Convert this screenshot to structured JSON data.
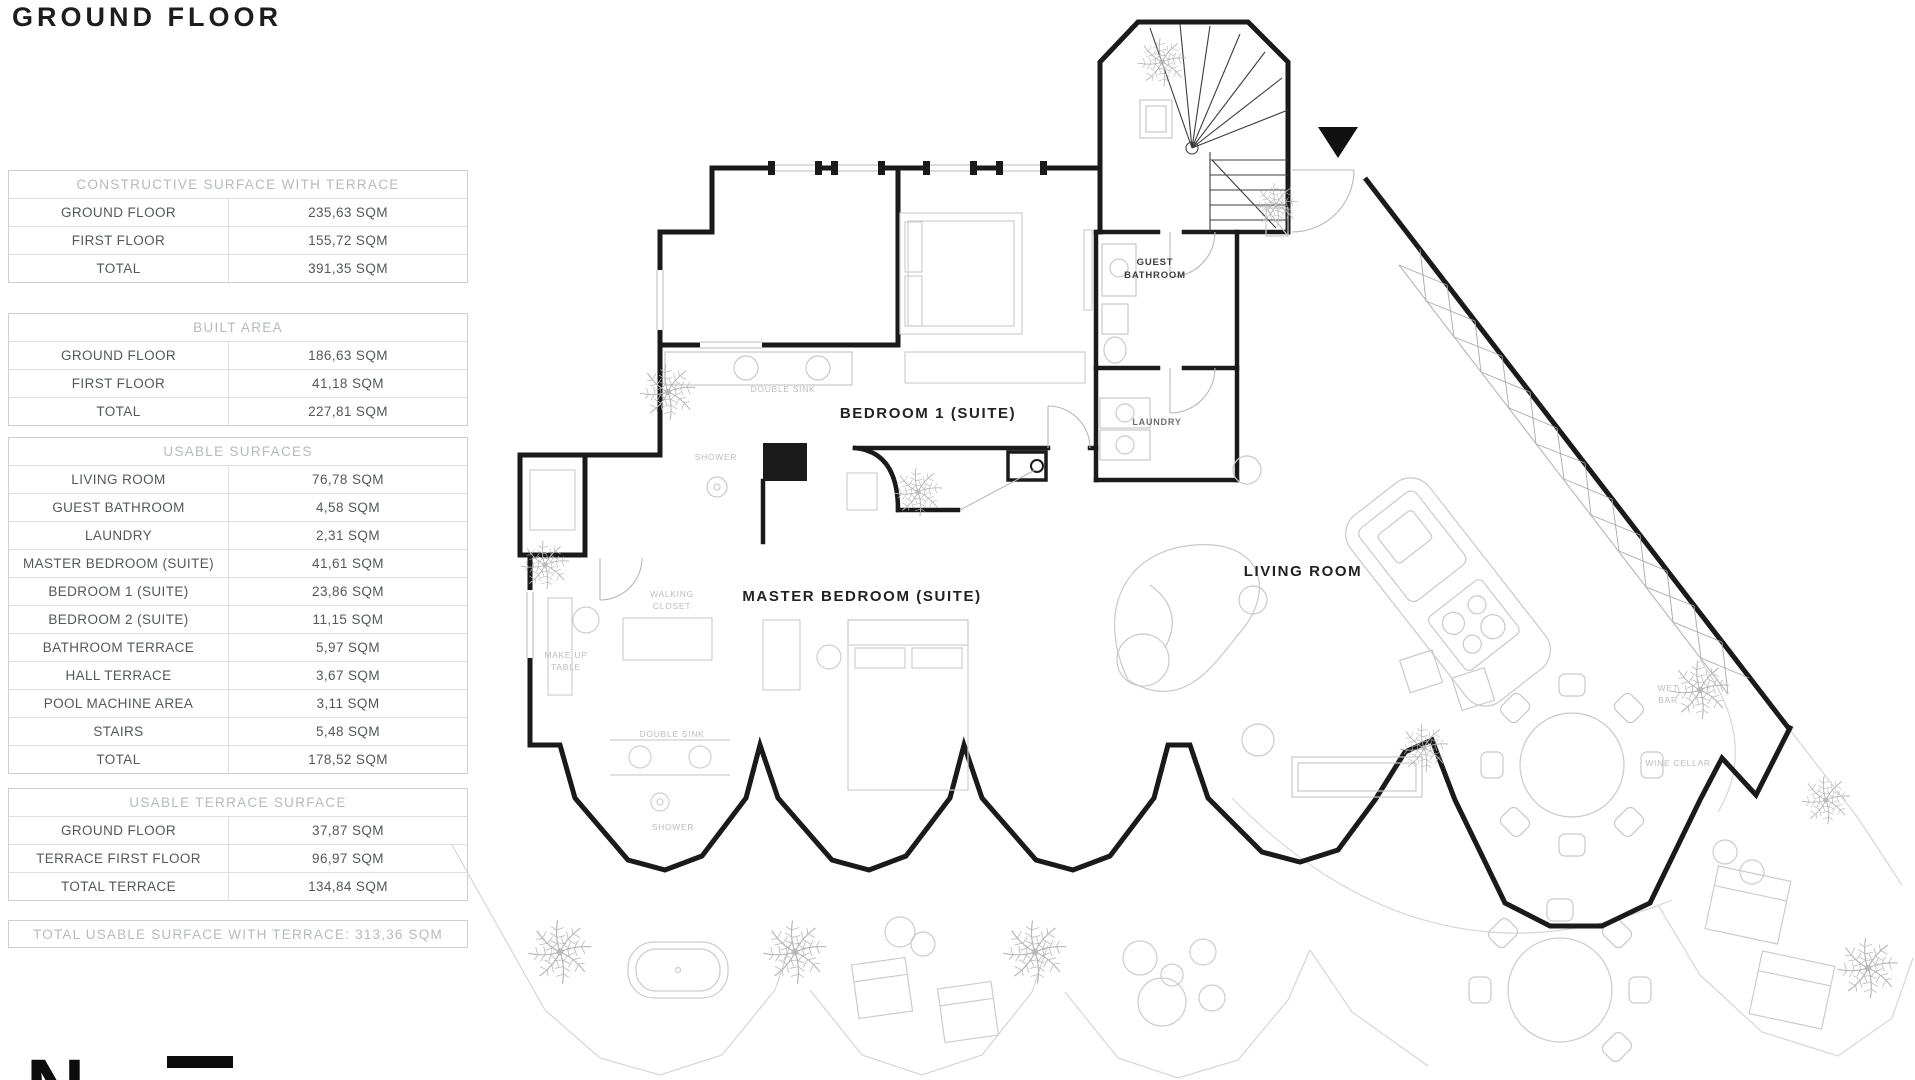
{
  "title": "GROUND FLOOR",
  "tables": {
    "constructive": {
      "header": "CONSTRUCTIVE SURFACE WITH TERRACE",
      "rows": [
        {
          "label": "GROUND FLOOR",
          "value": "235,63 SQM"
        },
        {
          "label": "FIRST FLOOR",
          "value": "155,72 SQM"
        },
        {
          "label": "TOTAL",
          "value": "391,35 SQM"
        }
      ]
    },
    "built": {
      "header": "BUILT AREA",
      "rows": [
        {
          "label": "GROUND FLOOR",
          "value": "186,63 SQM"
        },
        {
          "label": "FIRST FLOOR",
          "value": "41,18 SQM"
        },
        {
          "label": "TOTAL",
          "value": "227,81 SQM"
        }
      ]
    },
    "usable": {
      "header": "USABLE SURFACES",
      "rows": [
        {
          "label": "LIVING ROOM",
          "value": "76,78 SQM"
        },
        {
          "label": "GUEST BATHROOM",
          "value": "4,58 SQM"
        },
        {
          "label": "LAUNDRY",
          "value": "2,31 SQM"
        },
        {
          "label": "MASTER BEDROOM (SUITE)",
          "value": "41,61 SQM"
        },
        {
          "label": "BEDROOM 1 (SUITE)",
          "value": "23,86 SQM"
        },
        {
          "label": "BEDROOM 2 (SUITE)",
          "value": "11,15 SQM"
        },
        {
          "label": "BATHROOM TERRACE",
          "value": "5,97 SQM"
        },
        {
          "label": "HALL TERRACE",
          "value": "3,67 SQM"
        },
        {
          "label": "POOL MACHINE AREA",
          "value": "3,11 SQM"
        },
        {
          "label": "STAIRS",
          "value": "5,48 SQM"
        },
        {
          "label": "TOTAL",
          "value": "178,52 SQM"
        }
      ]
    },
    "terrace": {
      "header": "USABLE TERRACE SURFACE",
      "rows": [
        {
          "label": "GROUND FLOOR",
          "value": "37,87 SQM"
        },
        {
          "label": "TERRACE FIRST FLOOR",
          "value": "96,97 SQM"
        },
        {
          "label": "TOTAL TERRACE",
          "value": "134,84 SQM"
        }
      ]
    }
  },
  "total_summary": "TOTAL USABLE SURFACE WITH TERRACE:  313,36 SQM",
  "plan": {
    "guest_bathroom_l1": "GUEST",
    "guest_bathroom_l2": "BATHROOM",
    "laundry": "LAUNDRY",
    "bedroom1": "BEDROOM 1 (SUITE)",
    "master_bedroom": "MASTER BEDROOM (SUITE)",
    "living_room": "LIVING ROOM",
    "double_sink_1": "DOUBLE SINK",
    "shower_1": "SHOWER",
    "walking_l1": "WALKING",
    "walking_l2": "CLOSET",
    "makeup_l1": "MAKE UP",
    "makeup_l2": "TABLE",
    "double_sink_2": "DOUBLE SINK",
    "shower_2": "SHOWER",
    "wet_bar_l1": "WET",
    "wet_bar_l2": "BAR",
    "wine_cellar": "WINE CELLAR"
  },
  "compass_letter": "N",
  "colors": {
    "wall": "#1a1a1a",
    "furniture": "#c9c9c9",
    "light_label": "#bcbcbc"
  }
}
